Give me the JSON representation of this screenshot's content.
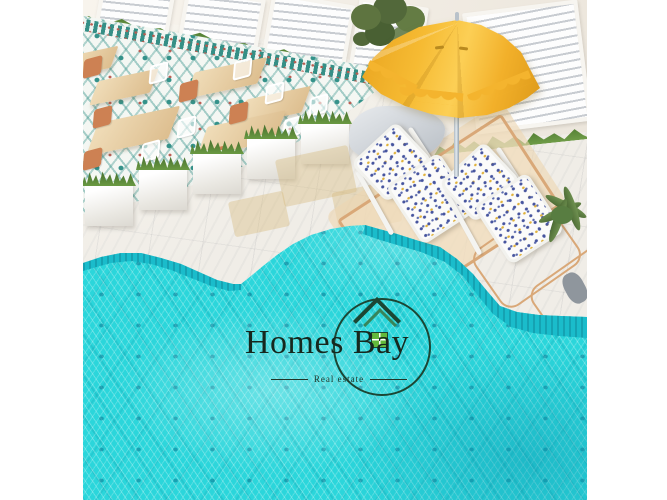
{
  "watermark": {
    "brand": "Homes Bay",
    "tagline": "Real estate",
    "icon": "house-icon"
  },
  "scene": {
    "setting": "aerial render of a resort pool terrace",
    "elements": [
      "turquoise mosaic swimming pool",
      "white marble deck",
      "teal patterned tile dining area",
      "wooden cafe tables with white and orange chairs",
      "white cube planters with grass",
      "yellow fringed parasol",
      "two floral-cushion sun loungers on tan mat",
      "green shrub",
      "palm plant",
      "cream wall with slatted shutters",
      "grass border",
      "gray towels"
    ]
  },
  "palette": {
    "pool_water": "#2bd6db",
    "pool_deep": "#0fa3bd",
    "umbrella": "#f4b42e",
    "marble": "#f0ede7",
    "wall": "#f4efe8",
    "grass": "#5d8a3a",
    "tile_teal": "#35928a",
    "tan": "#d9a878",
    "wood": "#e7cb9e",
    "chair_orange": "#cd8153",
    "lounger_blue": "#46549e",
    "lounger_gold": "#e0b23c",
    "logo_green": "#1c4634",
    "logo_light_green": "#63b93c",
    "ink": "#16281e"
  }
}
